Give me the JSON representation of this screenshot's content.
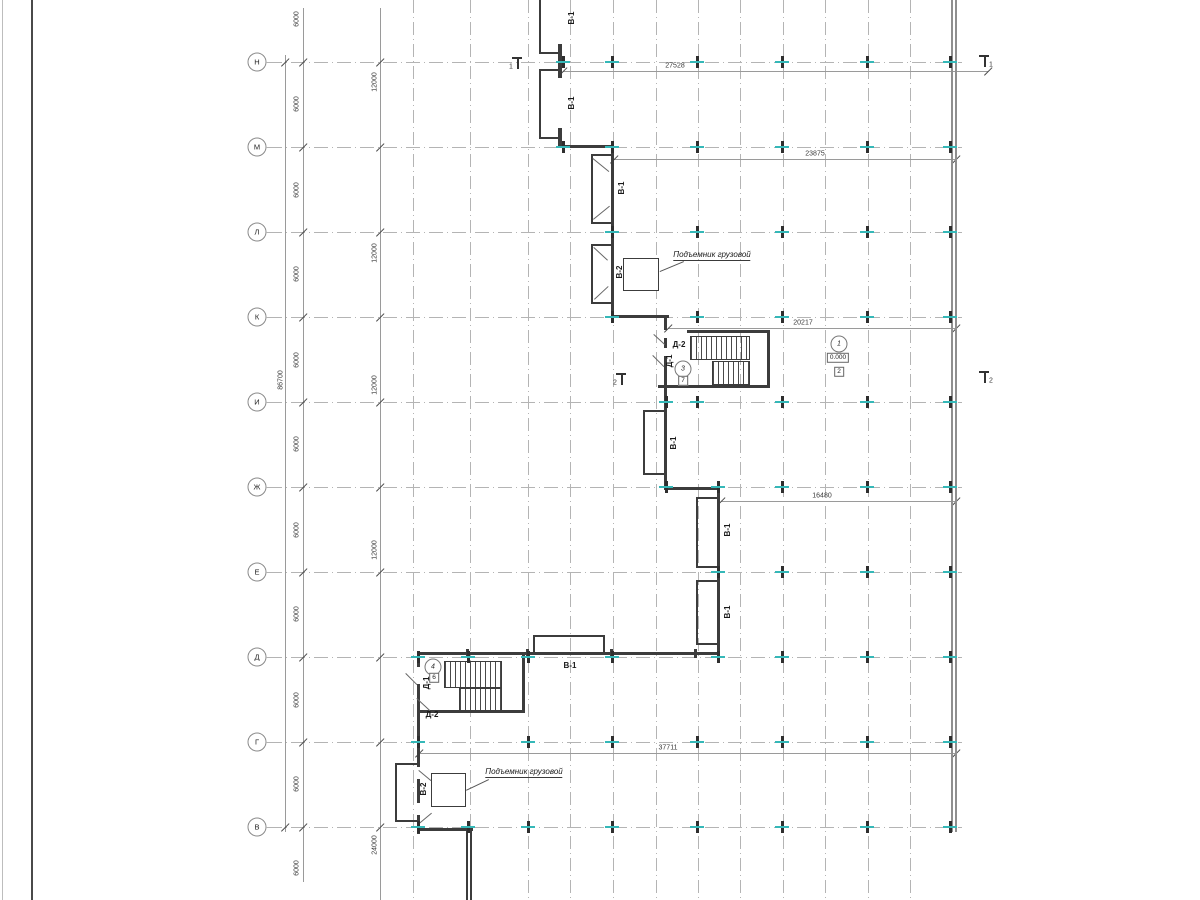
{
  "title": "Floor plan drawing (план этажа)",
  "colors": {
    "background": "#ffffff",
    "grid": "#b4b4b4",
    "dim_line": "#9a9a9a",
    "wall": "#3c3c3c",
    "wall_light": "#8f8f8f",
    "column_accent": "#35b8b8",
    "text": "#1a1a1a",
    "frame": "#4a4a4a"
  },
  "sheet_frame_lines": [
    [
      31,
      0,
      1.5,
      900,
      "#4a4a4a"
    ],
    [
      2,
      0,
      1,
      900,
      "#bdbdbd"
    ]
  ],
  "axes": {
    "bubble_x": 257,
    "line_x1": 268,
    "line_x2": 962,
    "rows": [
      {
        "label": "Н",
        "y": 62
      },
      {
        "label": "М",
        "y": 147
      },
      {
        "label": "Л",
        "y": 232
      },
      {
        "label": "К",
        "y": 317
      },
      {
        "label": "И",
        "y": 402
      },
      {
        "label": "Ж",
        "y": 487
      },
      {
        "label": "Е",
        "y": 572
      },
      {
        "label": "Д",
        "y": 657
      },
      {
        "label": "Г",
        "y": 742
      },
      {
        "label": "В",
        "y": 827
      }
    ]
  },
  "grid_columns": [
    413,
    470,
    528,
    570,
    613,
    656,
    698,
    740,
    783,
    825,
    868,
    910
  ],
  "column_ticks": [
    {
      "y": 62,
      "xs": [
        563,
        612,
        697,
        782,
        867,
        950
      ]
    },
    {
      "y": 147,
      "xs": [
        563,
        612,
        697,
        782,
        867,
        950
      ]
    },
    {
      "y": 232,
      "xs": [
        612,
        697,
        782,
        867,
        950
      ]
    },
    {
      "y": 317,
      "xs": [
        612,
        697,
        782,
        867,
        950
      ]
    },
    {
      "y": 402,
      "xs": [
        666,
        697,
        782,
        867,
        950
      ]
    },
    {
      "y": 487,
      "xs": [
        666,
        718,
        782,
        867,
        950
      ]
    },
    {
      "y": 572,
      "xs": [
        718,
        782,
        867,
        950
      ]
    },
    {
      "y": 657,
      "xs": [
        418,
        468,
        528,
        612,
        718,
        782,
        867,
        950
      ]
    },
    {
      "y": 742,
      "xs": [
        418,
        528,
        612,
        697,
        782,
        867,
        950
      ]
    },
    {
      "y": 827,
      "xs": [
        418,
        468,
        528,
        612,
        697,
        782,
        867,
        950
      ]
    }
  ],
  "dims_h": [
    {
      "y": 71,
      "x1": 563,
      "x2": 988,
      "label": "27528",
      "lx": 675
    },
    {
      "y": 159,
      "x1": 614,
      "x2": 956,
      "label": "23875",
      "lx": 815
    },
    {
      "y": 328,
      "x1": 668,
      "x2": 956,
      "label": "20217",
      "lx": 803
    },
    {
      "y": 501,
      "x1": 721,
      "x2": 956,
      "label": "16480",
      "lx": 822
    },
    {
      "y": 753,
      "x1": 419,
      "x2": 956,
      "label": "37711",
      "lx": 668
    }
  ],
  "dims_v": {
    "total": {
      "x": 285,
      "y1": 55,
      "y2": 832,
      "label": "86700",
      "ly": 380
    },
    "chain_a": {
      "x": 303,
      "y1": 8,
      "y2": 882,
      "label": "6000",
      "label_ys": [
        19,
        104,
        190,
        274,
        360,
        444,
        530,
        614,
        700,
        784,
        868
      ]
    },
    "chain_b": {
      "x": 380,
      "y1": 8,
      "y2": 900,
      "labels": [
        {
          "t": "12000",
          "y": 82
        },
        {
          "t": "12000",
          "y": 253
        },
        {
          "t": "12000",
          "y": 385
        },
        {
          "t": "12000",
          "y": 550
        },
        {
          "t": "24000",
          "y": 845
        }
      ]
    }
  },
  "walls": [
    [
      539,
      0,
      2,
      54
    ],
    [
      539,
      52,
      23,
      2
    ],
    [
      558,
      44,
      4,
      34
    ],
    [
      539,
      69,
      23,
      2
    ],
    [
      539,
      69,
      2,
      70
    ],
    [
      539,
      137,
      23,
      2
    ],
    [
      558,
      128,
      4,
      19
    ],
    [
      560,
      145,
      54,
      3
    ],
    [
      611,
      145,
      3,
      92
    ],
    [
      591,
      154,
      2,
      70
    ],
    [
      591,
      154,
      21,
      2
    ],
    [
      591,
      222,
      21,
      2
    ],
    [
      611,
      235,
      3,
      85
    ],
    [
      591,
      244,
      2,
      60
    ],
    [
      591,
      244,
      21,
      2
    ],
    [
      591,
      302,
      21,
      2
    ],
    [
      611,
      315,
      58,
      3
    ],
    [
      664,
      318,
      3,
      12
    ],
    [
      664,
      338,
      3,
      10
    ],
    [
      664,
      356,
      3,
      48
    ],
    [
      664,
      402,
      3,
      88
    ],
    [
      643,
      410,
      2,
      65
    ],
    [
      643,
      410,
      22,
      2
    ],
    [
      643,
      473,
      22,
      2
    ],
    [
      664,
      487,
      56,
      3
    ],
    [
      717,
      490,
      3,
      165
    ],
    [
      696,
      497,
      2,
      71
    ],
    [
      696,
      497,
      22,
      2
    ],
    [
      696,
      566,
      22,
      2
    ],
    [
      696,
      580,
      2,
      65
    ],
    [
      696,
      580,
      22,
      2
    ],
    [
      696,
      643,
      22,
      2
    ],
    [
      417,
      652,
      303,
      3
    ],
    [
      466,
      649,
      3,
      9
    ],
    [
      526,
      649,
      3,
      9
    ],
    [
      610,
      649,
      3,
      9
    ],
    [
      694,
      649,
      3,
      9
    ],
    [
      533,
      635,
      72,
      2
    ],
    [
      533,
      635,
      2,
      19
    ],
    [
      603,
      635,
      2,
      19
    ],
    [
      687,
      330,
      83,
      3
    ],
    [
      767,
      330,
      3,
      58
    ],
    [
      658,
      385,
      112,
      3
    ],
    [
      417,
      655,
      3,
      12
    ],
    [
      417,
      684,
      3,
      28
    ],
    [
      417,
      710,
      108,
      3
    ],
    [
      522,
      655,
      3,
      58
    ],
    [
      417,
      712,
      3,
      55
    ],
    [
      417,
      779,
      3,
      24
    ],
    [
      417,
      815,
      3,
      16
    ],
    [
      395,
      763,
      22,
      2
    ],
    [
      395,
      763,
      2,
      58
    ],
    [
      395,
      820,
      22,
      2
    ],
    [
      417,
      826,
      3,
      8
    ],
    [
      417,
      828,
      56,
      3
    ],
    [
      466,
      831,
      2,
      69
    ],
    [
      470,
      831,
      2,
      69
    ]
  ],
  "walls_light": [
    [
      951,
      0,
      2,
      832
    ],
    [
      955,
      0,
      2,
      832
    ]
  ],
  "stair_flights": [
    [
      690,
      336,
      58,
      22
    ],
    [
      712,
      361,
      36,
      22
    ],
    [
      444,
      661,
      56,
      25
    ],
    [
      459,
      688,
      41,
      21
    ]
  ],
  "elevator_shafts": [
    [
      623,
      258,
      34,
      31
    ],
    [
      431,
      773,
      33,
      32
    ]
  ],
  "elevator_labels": [
    {
      "text": "Подъемник грузовой",
      "x": 712,
      "y": 256
    },
    {
      "text": "Подъемник грузовой",
      "x": 524,
      "y": 773
    }
  ],
  "leader_lines": [
    [
      684,
      262,
      660,
      272
    ],
    [
      489,
      780,
      466,
      791
    ]
  ],
  "door_diagonals": [
    [
      594,
      247,
      608,
      260
    ],
    [
      594,
      299,
      608,
      286
    ],
    [
      593,
      158,
      609,
      171
    ],
    [
      593,
      219,
      609,
      206
    ],
    [
      654,
      334,
      665,
      344
    ],
    [
      653,
      355,
      664,
      366
    ],
    [
      406,
      673,
      417,
      684
    ],
    [
      417,
      698,
      430,
      710
    ],
    [
      419,
      770,
      431,
      780
    ],
    [
      419,
      823,
      431,
      813
    ]
  ],
  "type_labels": [
    {
      "t": "В-1",
      "x": 572,
      "y": 18,
      "rot": 1
    },
    {
      "t": "В-1",
      "x": 572,
      "y": 103,
      "rot": 1
    },
    {
      "t": "В-1",
      "x": 622,
      "y": 188,
      "rot": 1
    },
    {
      "t": "В-1",
      "x": 674,
      "y": 443,
      "rot": 1
    },
    {
      "t": "В-1",
      "x": 728,
      "y": 530,
      "rot": 1
    },
    {
      "t": "В-1",
      "x": 728,
      "y": 612,
      "rot": 1
    },
    {
      "t": "В-1",
      "x": 570,
      "y": 666,
      "rot": 0
    },
    {
      "t": "В-2",
      "x": 620,
      "y": 272,
      "rot": 1
    },
    {
      "t": "В-2",
      "x": 424,
      "y": 789,
      "rot": 1
    },
    {
      "t": "Д-2",
      "x": 679,
      "y": 345,
      "rot": 0
    },
    {
      "t": "Д-1",
      "x": 670,
      "y": 361,
      "rot": 1
    },
    {
      "t": "Д-1",
      "x": 427,
      "y": 683,
      "rot": 1
    },
    {
      "t": "Д-2",
      "x": 432,
      "y": 715,
      "rot": 0
    }
  ],
  "room_marks": [
    {
      "num": "3",
      "x": 683,
      "y": 369,
      "tag": "7",
      "tx": 683,
      "ty": 381
    },
    {
      "num": "1",
      "x": 839,
      "y": 344,
      "elev": "0.000",
      "ex": 838,
      "ey": 358,
      "tag": "2",
      "tx": 839,
      "ty": 372
    },
    {
      "num": "4",
      "x": 433,
      "y": 667,
      "tag": "6",
      "tx": 434,
      "ty": 678
    }
  ],
  "section_marks": [
    {
      "t": "1",
      "x": 517,
      "y": 57,
      "side": "left"
    },
    {
      "t": "1",
      "x": 984,
      "y": 55,
      "side": "right"
    },
    {
      "t": "2",
      "x": 621,
      "y": 373,
      "side": "left"
    },
    {
      "t": "2",
      "x": 984,
      "y": 371,
      "side": "right"
    }
  ]
}
